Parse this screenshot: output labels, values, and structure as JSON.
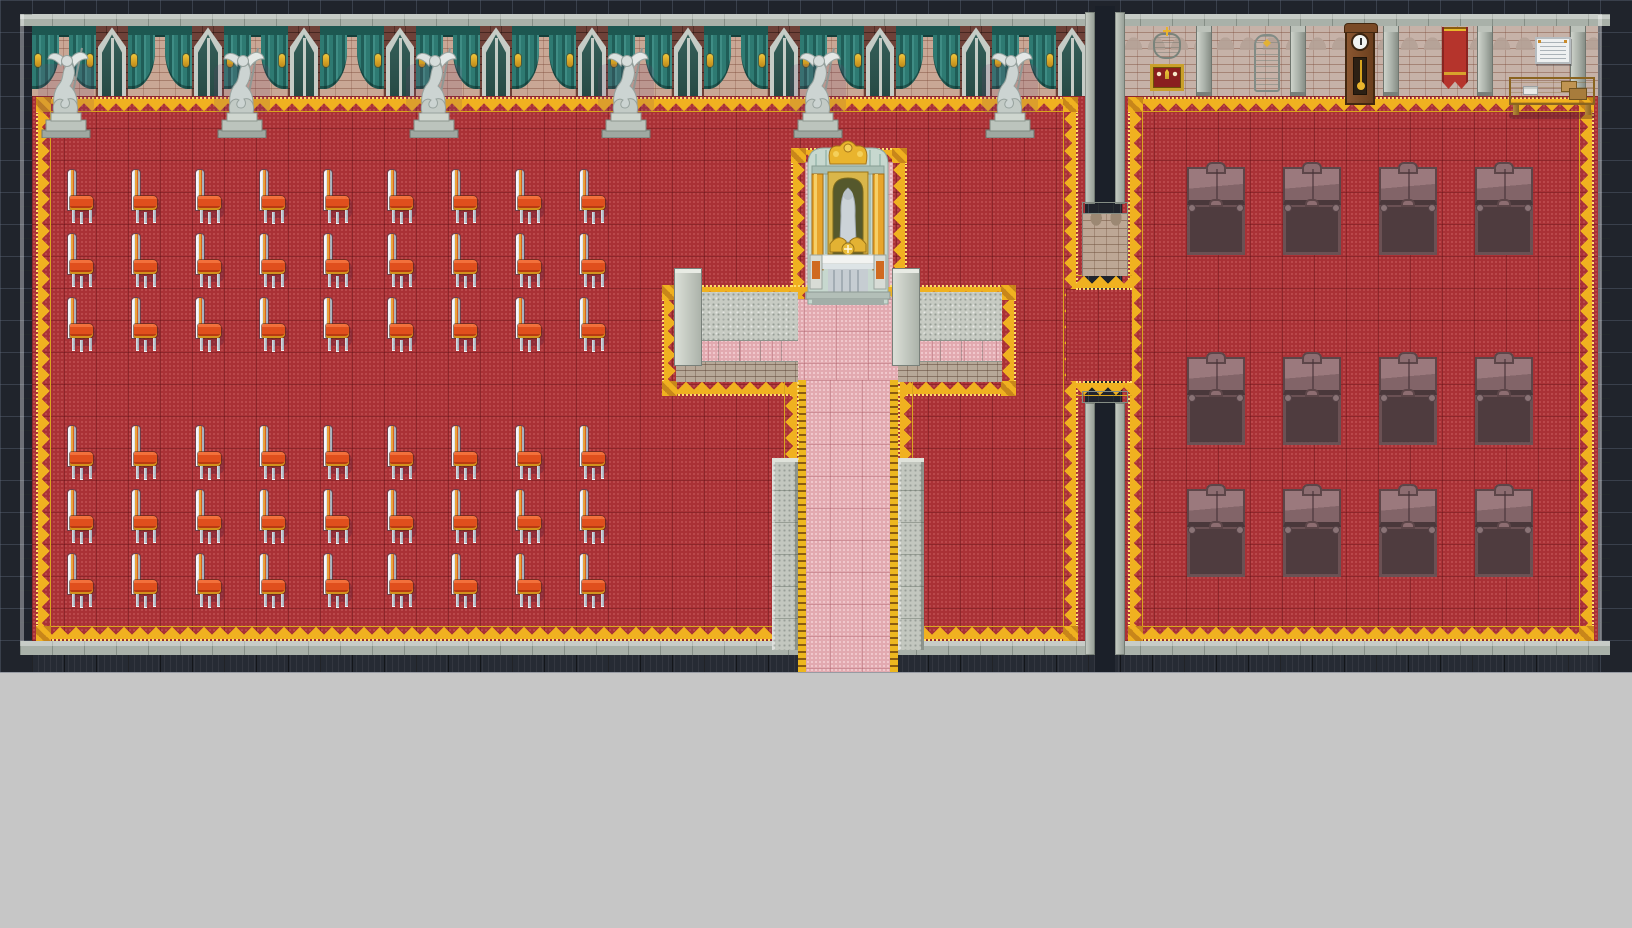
{
  "scene": {
    "app": "rpg-map-view",
    "description": "Top-down pixel-art map: cathedral chapel with chair rows (left), gilded altar sanctuary with pink processional carpet (center), library wing with bookshelves (right), on a dark gridded editor canvas with a plain gray area below the map.",
    "tile_size": 32,
    "map_width": 1632,
    "map_height": 672,
    "footer_height": 256
  },
  "palette": {
    "canvas_bg": "#20242c",
    "grid_line": "#5a6378",
    "editor_gray": "#c6c6c6",
    "carpet_red": "#a93136",
    "carpet_pink": "#e2a9b0",
    "gold_trim": "#f0b120",
    "gold_dotted": "#ffdf6e",
    "curtain_teal": "#2e7a72",
    "brick_light": "#c9a795",
    "brick_dark": "#6e4138",
    "stone_light": "#cdd2ca",
    "stone_speckle": "#c7cbc3",
    "wood_shelf": "#7c5d61",
    "wood_desk": "#cb9d46",
    "chair_cushion": "#e04f1d",
    "book_colors": [
      "#c2485a",
      "#3a78b5",
      "#4aa35c",
      "#d2452f",
      "#36a3a3",
      "#b8a030",
      "#2f5880",
      "#caa84a"
    ]
  },
  "church": {
    "chairs": {
      "label": "high-back chapel chair",
      "cols_x": [
        64,
        128,
        192,
        256,
        320,
        384,
        448,
        512,
        576
      ],
      "rows_y": [
        168,
        232,
        296,
        424,
        488,
        552
      ],
      "count": 54
    },
    "statues": {
      "label": "winged angel statue",
      "centers_x": [
        66,
        242,
        434,
        626,
        818,
        1010
      ],
      "top_y": 42,
      "count": 6
    },
    "curtain_band": {
      "start_x": 32,
      "unit_width": 96,
      "units": 11
    }
  },
  "library": {
    "bookshelves": {
      "label": "library bookshelf",
      "cols_x": [
        1187,
        1283,
        1379,
        1475
      ],
      "rows_y": [
        167,
        357,
        489
      ],
      "count": 12
    },
    "pilasters_x": [
      1103,
      1196,
      1290,
      1383,
      1477,
      1570
    ],
    "wall_items": [
      {
        "type": "crest-shrine",
        "x": 1150,
        "y": 33
      },
      {
        "type": "monument",
        "x": 1254,
        "y": 34
      },
      {
        "type": "grandfather-clock",
        "x": 1345,
        "y": 27
      },
      {
        "type": "banner",
        "x": 1442,
        "y": 27
      },
      {
        "type": "bulletin-paper",
        "x": 1535,
        "y": 37
      },
      {
        "type": "reading-desk",
        "x": 1509,
        "y": 77
      }
    ]
  },
  "sanctuary": {
    "altar": {
      "label": "gilded altar with veiled madonna statue",
      "x": 800,
      "y": 136
    }
  }
}
